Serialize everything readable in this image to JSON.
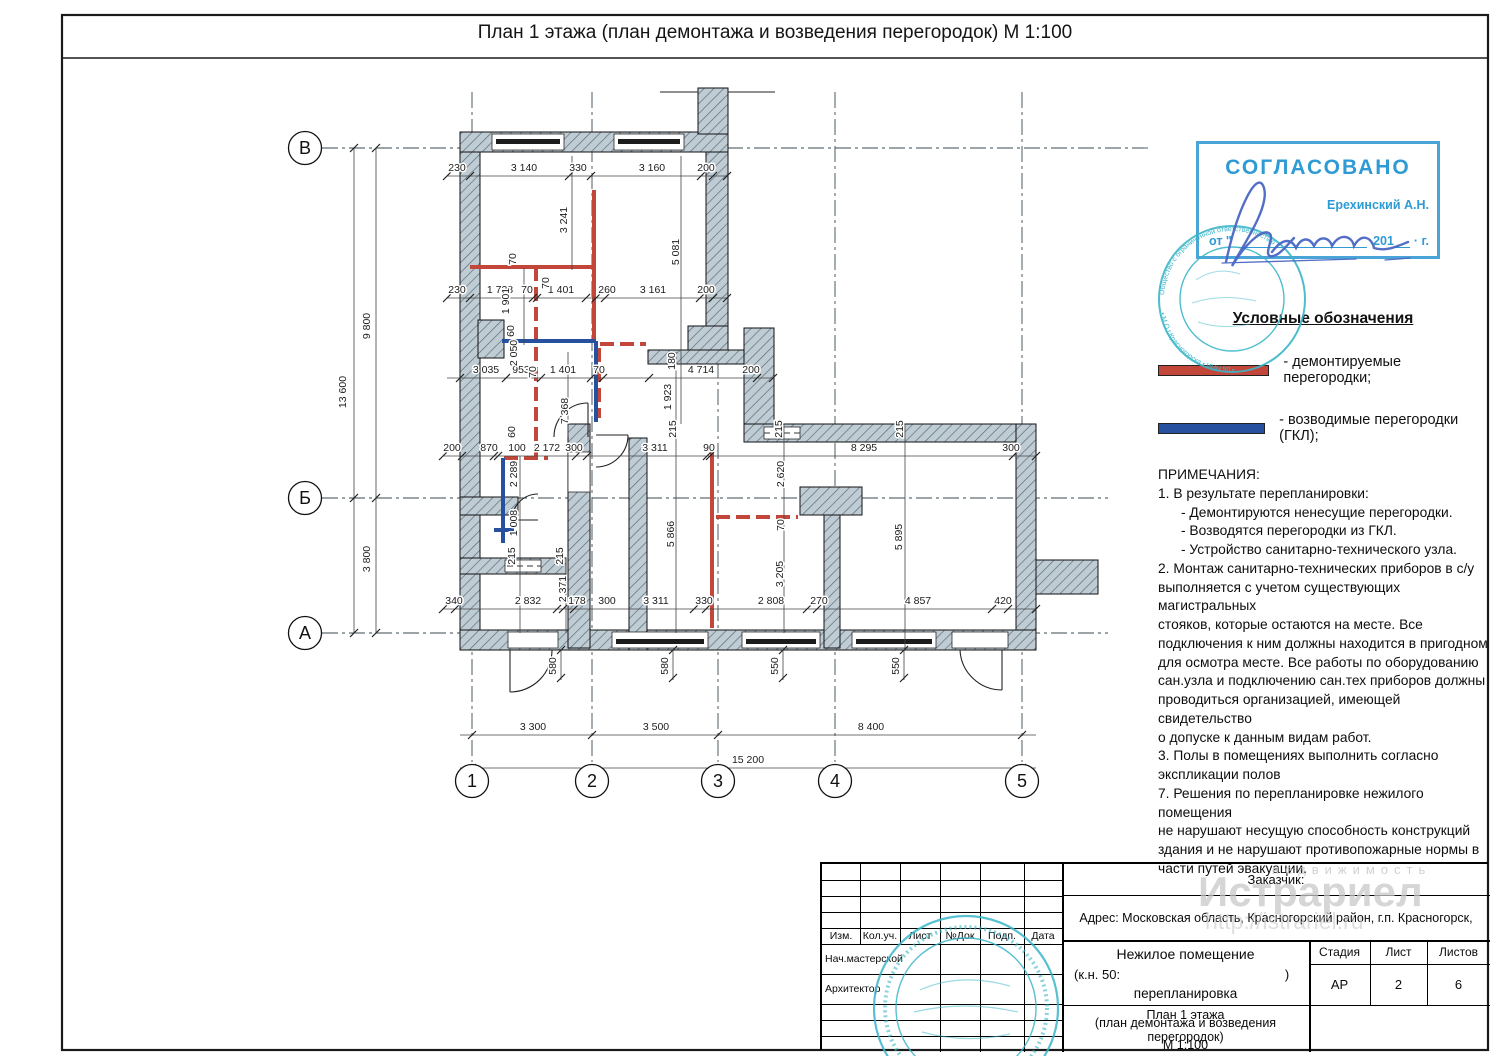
{
  "page": {
    "title": "План 1 этажа (план демонтажа и возведения перегородок) М 1:100"
  },
  "approval_stamp": {
    "approved": "СОГЛАСОВАНО",
    "name": "Ерехинский А.Н.",
    "date_from": "от \"",
    "date_year": "201",
    "date_suffix": "· г."
  },
  "seal": {
    "ring_top": "Общество с ограниченной ответственностью",
    "ring_bottom": "• М.О.г.Красногорска • ИНН 50 •"
  },
  "legend": {
    "heading": "Условные обозначения",
    "items": [
      {
        "label": "- демонтируемые перегородки;",
        "color": "#c2473a"
      },
      {
        "label": "- возводимые перегородки (ГКЛ);",
        "color": "#27509e"
      }
    ]
  },
  "notes": {
    "heading": "ПРИМЕЧАНИЯ:",
    "lines": [
      "1. В результате перепланировки:",
      "      - Демонтируются ненесущие перегородки.",
      "      - Возводятся перегородки из ГКЛ.",
      "      - Устройство санитарно-технического узла.",
      "2. Монтаж санитарно-технических приборов в с/у",
      "выполняется с учетом существующих магистральных",
      "стояков, которые остаются на месте. Все",
      "подключения к ним должны находится в пригодном",
      "для осмотра месте. Все работы по оборудованию",
      "сан.узла и подключению сан.тех приборов должны",
      "проводиться организацией, имеющей свидетельство",
      "о допуске к данным видам работ.",
      "3. Полы в помещениях выполнить согласно",
      "экспликации полов",
      "7. Решения по перепланировке нежилого помещения",
      "не нарушают несущую способность конструкций",
      "здания и не нарушают противопожарные нормы в",
      "части путей эвакуации."
    ]
  },
  "plan": {
    "axes_h": [
      {
        "label": "В",
        "x": 305,
        "y": 148
      },
      {
        "label": "Б",
        "x": 305,
        "y": 498
      },
      {
        "label": "А",
        "x": 305,
        "y": 633
      }
    ],
    "axes_v": [
      {
        "label": "1",
        "x": 472,
        "y": 781
      },
      {
        "label": "2",
        "x": 592,
        "y": 781
      },
      {
        "label": "3",
        "x": 718,
        "y": 781
      },
      {
        "label": "4",
        "x": 835,
        "y": 781
      },
      {
        "label": "5",
        "x": 1022,
        "y": 781
      }
    ],
    "dimensions": [
      {
        "t": "230",
        "x": 457,
        "y": 171
      },
      {
        "t": "3 140",
        "x": 524,
        "y": 171
      },
      {
        "t": "330",
        "x": 578,
        "y": 171
      },
      {
        "t": "3 160",
        "x": 652,
        "y": 171
      },
      {
        "t": "200",
        "x": 706,
        "y": 171
      },
      {
        "t": "230",
        "x": 457,
        "y": 293
      },
      {
        "t": "1 738",
        "x": 500,
        "y": 293
      },
      {
        "t": "70",
        "x": 527,
        "y": 293
      },
      {
        "t": "1 401",
        "x": 561,
        "y": 293
      },
      {
        "t": "260",
        "x": 607,
        "y": 293
      },
      {
        "t": "3 161",
        "x": 653,
        "y": 293
      },
      {
        "t": "200",
        "x": 706,
        "y": 293
      },
      {
        "t": "3 035",
        "x": 486,
        "y": 373
      },
      {
        "t": "953",
        "x": 521,
        "y": 373
      },
      {
        "t": "1 401",
        "x": 563,
        "y": 373
      },
      {
        "t": "70",
        "x": 599,
        "y": 373
      },
      {
        "t": "4 714",
        "x": 701,
        "y": 373
      },
      {
        "t": "200",
        "x": 751,
        "y": 373
      },
      {
        "t": "200",
        "x": 452,
        "y": 451
      },
      {
        "t": "870",
        "x": 489,
        "y": 451
      },
      {
        "t": "100",
        "x": 517,
        "y": 451
      },
      {
        "t": "2 172",
        "x": 547,
        "y": 451
      },
      {
        "t": "300",
        "x": 574,
        "y": 451
      },
      {
        "t": "3 311",
        "x": 655,
        "y": 451
      },
      {
        "t": "90",
        "x": 709,
        "y": 451
      },
      {
        "t": "8 295",
        "x": 864,
        "y": 451
      },
      {
        "t": "300",
        "x": 1011,
        "y": 451
      },
      {
        "t": "340",
        "x": 454,
        "y": 604
      },
      {
        "t": "2 832",
        "x": 528,
        "y": 604
      },
      {
        "t": "178",
        "x": 577,
        "y": 604
      },
      {
        "t": "300",
        "x": 607,
        "y": 604
      },
      {
        "t": "3 311",
        "x": 656,
        "y": 604
      },
      {
        "t": "330",
        "x": 704,
        "y": 604
      },
      {
        "t": "2 808",
        "x": 771,
        "y": 604
      },
      {
        "t": "270",
        "x": 819,
        "y": 604
      },
      {
        "t": "4 857",
        "x": 918,
        "y": 604
      },
      {
        "t": "420",
        "x": 1003,
        "y": 604
      },
      {
        "t": "3 300",
        "x": 533,
        "y": 730
      },
      {
        "t": "3 500",
        "x": 656,
        "y": 730
      },
      {
        "t": "8 400",
        "x": 871,
        "y": 730
      },
      {
        "t": "15 200",
        "x": 748,
        "y": 763
      },
      {
        "t": "13 600",
        "x": 346,
        "y": 392,
        "r": 1
      },
      {
        "t": "9 800",
        "x": 370,
        "y": 326,
        "r": 1
      },
      {
        "t": "3 800",
        "x": 370,
        "y": 559,
        "r": 1
      },
      {
        "t": "3 241",
        "x": 567,
        "y": 220,
        "r": 1
      },
      {
        "t": "5 081",
        "x": 679,
        "y": 252,
        "r": 1
      },
      {
        "t": "70",
        "x": 516,
        "y": 259,
        "r": 1
      },
      {
        "t": "70",
        "x": 549,
        "y": 283,
        "r": 1
      },
      {
        "t": "1 901",
        "x": 509,
        "y": 301,
        "r": 1
      },
      {
        "t": "60",
        "x": 514,
        "y": 331,
        "r": 1
      },
      {
        "t": "2 050",
        "x": 517,
        "y": 353,
        "r": 1
      },
      {
        "t": "70",
        "x": 536,
        "y": 372,
        "r": 1
      },
      {
        "t": "7 368",
        "x": 568,
        "y": 411,
        "r": 1
      },
      {
        "t": "60",
        "x": 515,
        "y": 432,
        "r": 1
      },
      {
        "t": "180",
        "x": 675,
        "y": 361,
        "r": 1
      },
      {
        "t": "1 923",
        "x": 671,
        "y": 397,
        "r": 1
      },
      {
        "t": "215",
        "x": 676,
        "y": 429,
        "r": 1
      },
      {
        "t": "215",
        "x": 782,
        "y": 429,
        "r": 1
      },
      {
        "t": "215",
        "x": 903,
        "y": 429,
        "r": 1
      },
      {
        "t": "2 620",
        "x": 784,
        "y": 474,
        "r": 1
      },
      {
        "t": "70",
        "x": 784,
        "y": 525,
        "r": 1
      },
      {
        "t": "2 289",
        "x": 517,
        "y": 474,
        "r": 1
      },
      {
        "t": "1 008",
        "x": 517,
        "y": 523,
        "r": 1
      },
      {
        "t": "5 866",
        "x": 674,
        "y": 534,
        "r": 1
      },
      {
        "t": "5 895",
        "x": 902,
        "y": 537,
        "r": 1
      },
      {
        "t": "215",
        "x": 515,
        "y": 556,
        "r": 1
      },
      {
        "t": "215",
        "x": 563,
        "y": 556,
        "r": 1
      },
      {
        "t": "2 371",
        "x": 566,
        "y": 589,
        "r": 1
      },
      {
        "t": "3 205",
        "x": 783,
        "y": 574,
        "r": 1
      },
      {
        "t": "580",
        "x": 556,
        "y": 666,
        "r": 1
      },
      {
        "t": "580",
        "x": 668,
        "y": 666,
        "r": 1
      },
      {
        "t": "550",
        "x": 778,
        "y": 666,
        "r": 1
      },
      {
        "t": "550",
        "x": 899,
        "y": 666,
        "r": 1
      }
    ]
  },
  "titleblock": {
    "customer_label": "Заказчик:",
    "address": "Адрес: Московская область, Красногорский район, г.п. Красногорск,",
    "columns": [
      "Изм.",
      "Кол.уч.",
      "Лист",
      "№Док",
      "Подп.",
      "Дата"
    ],
    "rows": [
      "Нач.мастерской",
      "Архитектор"
    ],
    "object_line1": "Нежилое помещение",
    "object_line2_left": "(к.н. 50:",
    "object_line2_right": ")",
    "object_line3": "перепланировка",
    "sheet_title1": "План 1 этажа",
    "sheet_title2": "(план демонтажа и возведения перегородок)",
    "sheet_title3": "М 1:100",
    "stage_label": "Стадия",
    "list_label": "Лист",
    "lists_label": "Листов",
    "stage": "АР",
    "list": "2",
    "lists": "6"
  },
  "watermark": {
    "line1": "недвижимость",
    "line2": "Истрариел",
    "line3": "http://istrariel.ru"
  }
}
